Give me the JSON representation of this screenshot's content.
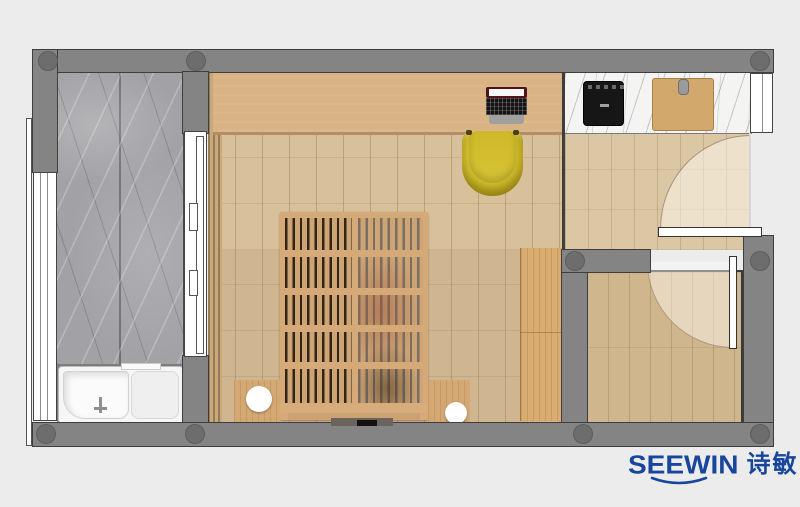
{
  "logo": {
    "brand": "SEEWIN",
    "brand_cn": "诗敏"
  },
  "palette": {
    "background": "#ececec",
    "wall": "#848484",
    "wallLine": "#3e3e3e",
    "column": "#6d6d6d",
    "marble": "#a2a1a5",
    "counter": "#f4f4f3",
    "desk": "#d9b385",
    "floorUpper": "#d8c09b",
    "floorLower": "#cfb691",
    "floorEntry": "#dcc7a4",
    "floorRoom2": "#cfb68d",
    "cabinet": "#d9ac72",
    "bedTan": "#d5aa78",
    "slat": "#cda575",
    "chair": "#cdb929",
    "stool": "#ffffff",
    "tub": "#f6f6f6",
    "doorWhite": "#ffffff",
    "logoBlue": "#17469c"
  },
  "plan": {
    "type": "apartment-floorplan-top-view",
    "rooms": [
      {
        "name": "bathroom",
        "floor": "gray-marble",
        "fixtures": [
          "walk-in-bathtub",
          "sliding-door",
          "window"
        ]
      },
      {
        "name": "main-room",
        "floor": "light-wood-planks",
        "fixtures": [
          "desk-counter",
          "laptop",
          "yellow-chair",
          "slatted-bed-platform",
          "bedside-blocks",
          "round-stools",
          "side-cabinet",
          "wardrobe-strip"
        ]
      },
      {
        "name": "kitchen-entry-hall",
        "floor": "light-wood-planks",
        "fixtures": [
          "white-marble-counter",
          "cooktop",
          "cutting-board",
          "entrance-door-swing",
          "window"
        ]
      },
      {
        "name": "secondary-room",
        "floor": "wood-planks",
        "fixtures": [
          "inward-door-swing"
        ]
      }
    ],
    "structure": [
      "concrete-walls",
      "round-columns",
      "balcony-edge-strip",
      "left-window-band"
    ]
  }
}
